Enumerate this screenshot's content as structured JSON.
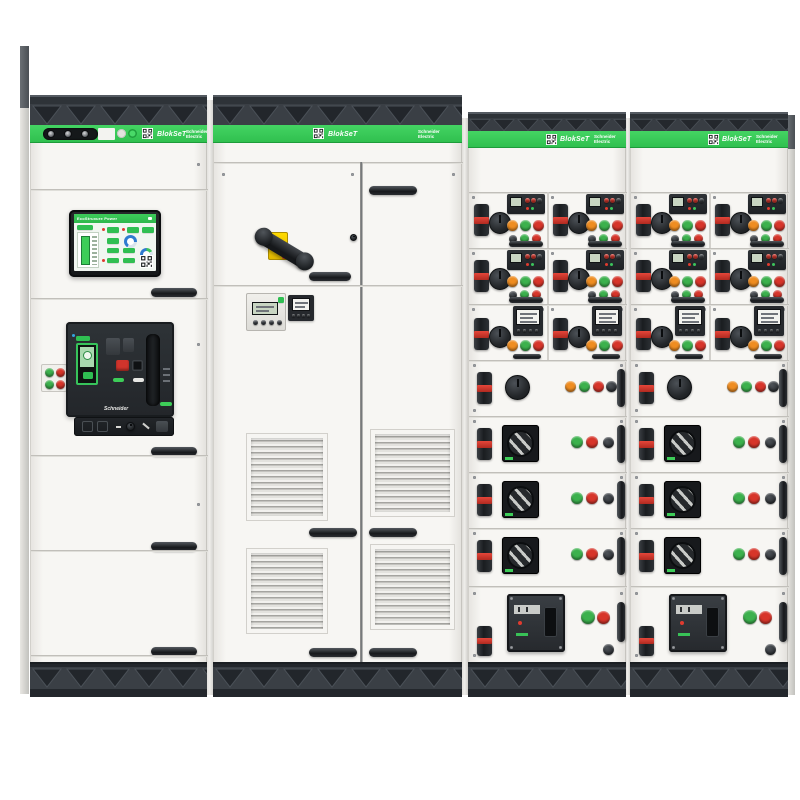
{
  "brand": {
    "product": "BlokSeT",
    "manufacturer_line1": "Schneider",
    "manufacturer_line2": "Electric"
  },
  "hmi": {
    "title": "EcoStruxure Power"
  },
  "acb": {
    "brand_label": "Schneider"
  },
  "colors": {
    "schneider_green": "#3DCD58",
    "charcoal_top": "#2E3338",
    "plinth_dark": "#23272C",
    "panel_white": "#F5F4F1",
    "signal_red": "#D7352A",
    "signal_green": "#3CB14D",
    "signal_amber": "#EF8D21",
    "handle_yellow": "#F2CF00",
    "gauge_blue": "#2F7BD0"
  },
  "icons": {
    "qr": "qr-code-icon",
    "truss": "vent-truss-pattern",
    "louver": "louver-grille",
    "gauge": "donut-gauge-icon"
  }
}
